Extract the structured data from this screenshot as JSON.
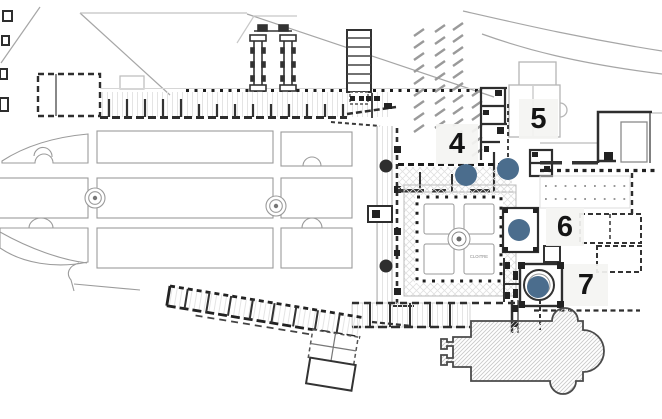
{
  "figure": {
    "type": "architectural-site-plan",
    "description": "Monastery site plan with cloister, church and numbered station markers"
  },
  "plan": {
    "cloister_label": "CLOITRE"
  },
  "markers": {
    "dot_color": "#4b6d8d",
    "panel_color": "rgba(244,244,242,0.93)",
    "number_color": "#151515",
    "dot_radius": 11,
    "points": [
      {
        "label": "4",
        "x": 466,
        "y": 175
      },
      {
        "label": "5",
        "x": 508,
        "y": 169
      },
      {
        "label": "6",
        "x": 519,
        "y": 230
      },
      {
        "label": "7",
        "x": 538,
        "y": 287
      }
    ],
    "labels": [
      {
        "text": "4",
        "x": 436,
        "y": 124,
        "w": 42,
        "h": 40
      },
      {
        "text": "5",
        "x": 519,
        "y": 99,
        "w": 39,
        "h": 40
      },
      {
        "text": "6",
        "x": 546,
        "y": 208,
        "w": 38,
        "h": 38
      },
      {
        "text": "7",
        "x": 564,
        "y": 264,
        "w": 44,
        "h": 42
      }
    ]
  }
}
